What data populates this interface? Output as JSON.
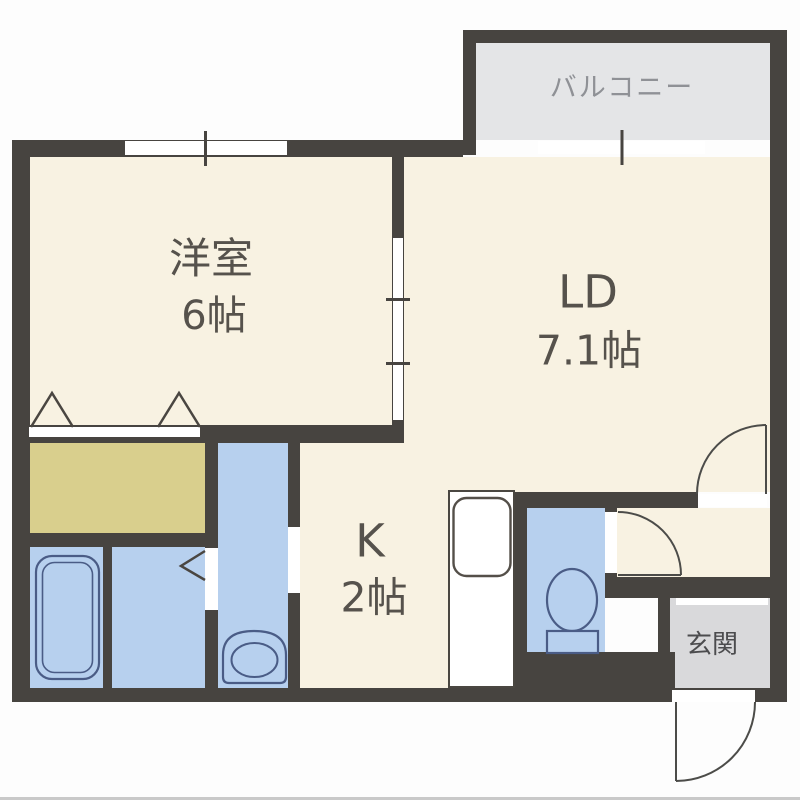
{
  "plan_type": "apartment-floor-plan",
  "rooms": {
    "western_room": {
      "name": "洋室",
      "size": "6帖"
    },
    "living_dining": {
      "name": "LD",
      "size": "7.1帖"
    },
    "kitchen": {
      "name": "K",
      "size": "2帖"
    },
    "balcony": {
      "name": "バルコニー"
    },
    "entrance": {
      "name": "玄関"
    }
  },
  "fixtures": [
    "bathtub",
    "washbasin",
    "toilet",
    "kitchen-sink"
  ],
  "colors": {
    "wall": "#474440",
    "room_floor": "#f8f2e2",
    "wet_area": "#b7d0ee",
    "closet": "#d9cf8d",
    "balcony_floor": "#e4e5e7",
    "entrance_floor": "#d9d9db",
    "fixture_outline": "#4a5c86",
    "room_text": "#56524c",
    "balcony_text": "#8f9196"
  }
}
